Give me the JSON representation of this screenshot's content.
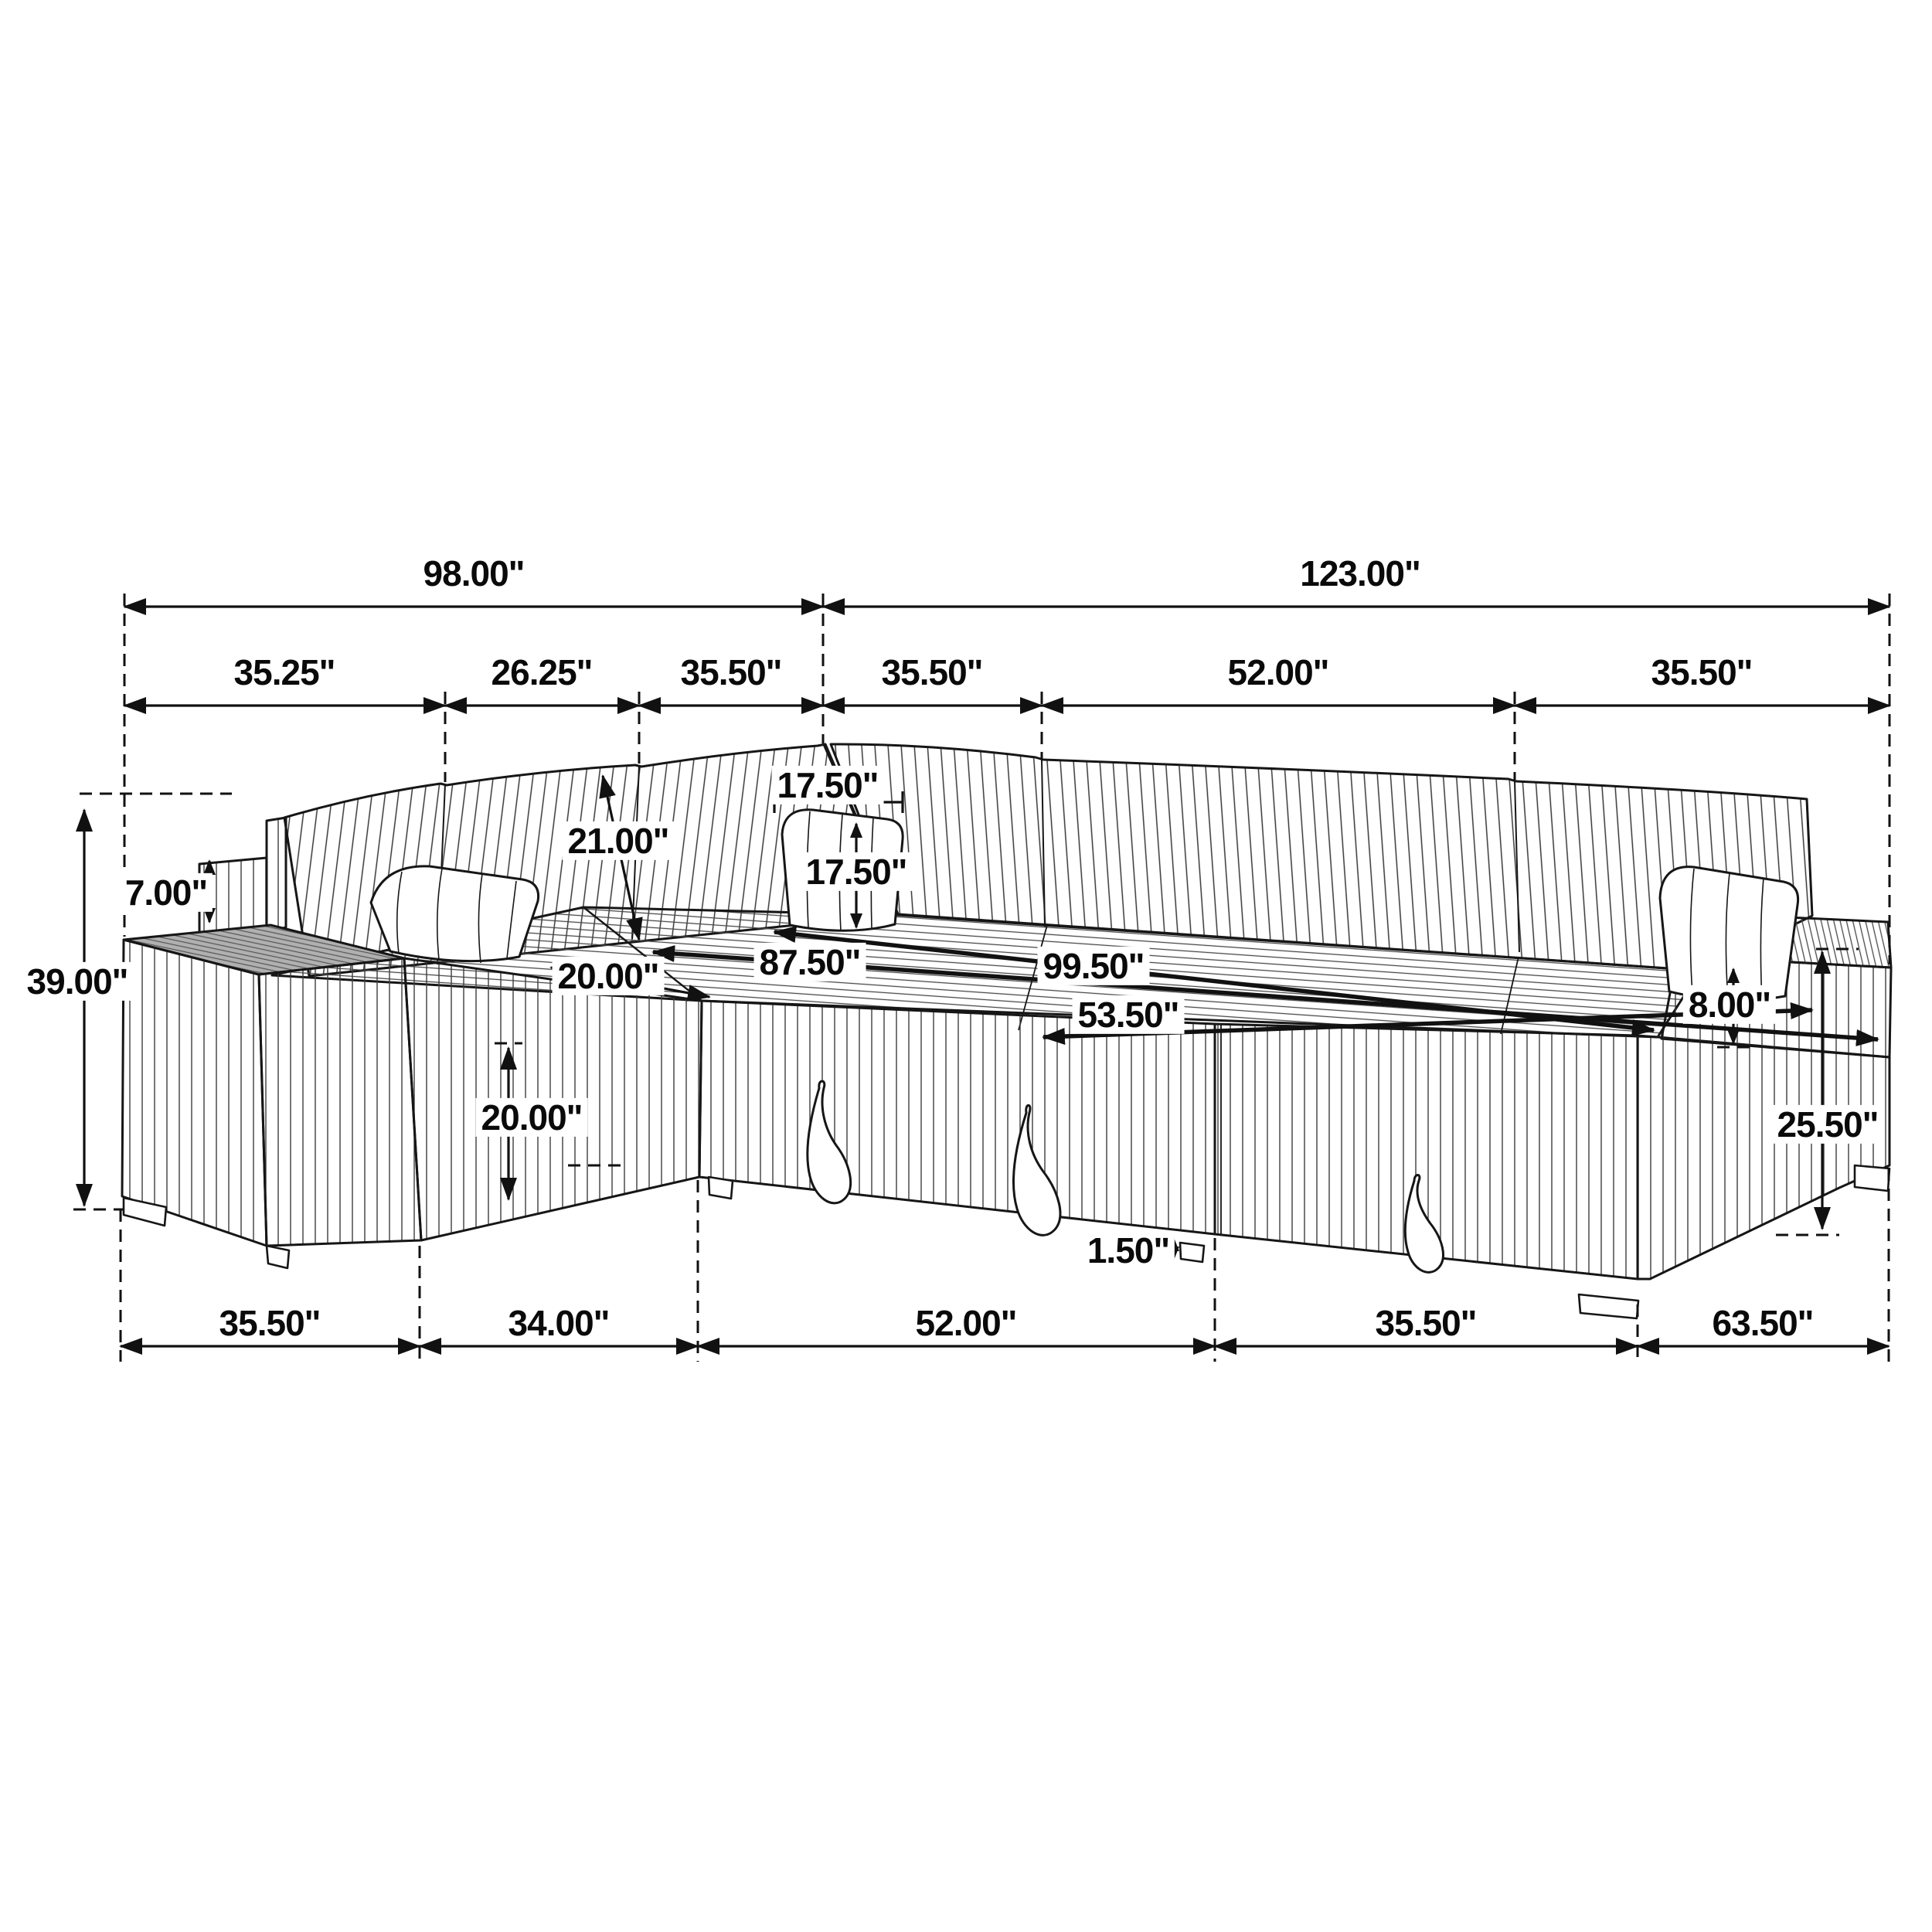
{
  "diagram": {
    "type": "furniture-dimension-diagram",
    "subject": "U-shaped sectional sleeper sofa with pull-out bed, storage chaise and armrest trays",
    "unit_suffix": "\"",
    "style": {
      "line_color": "#111111",
      "background": "#ffffff",
      "label_background": "#ffffff",
      "tray_gray": "#b0b0b0"
    }
  },
  "labels": {
    "dim_98": {
      "text": "98.00\""
    },
    "dim_123": {
      "text": "123.00\""
    },
    "dim_3525": {
      "text": "35.25\""
    },
    "dim_2625": {
      "text": "26.25\""
    },
    "dim_3550_a": {
      "text": "35.50\""
    },
    "dim_3550_b": {
      "text": "35.50\""
    },
    "dim_5200_a": {
      "text": "52.00\""
    },
    "dim_3550_c": {
      "text": "35.50\""
    },
    "dim_3900": {
      "text": "39.00\""
    },
    "dim_700": {
      "text": "7.00\""
    },
    "dim_2100": {
      "text": "21.00\""
    },
    "dim_1750_a": {
      "text": "17.50\""
    },
    "dim_1750_b": {
      "text": "17.50\""
    },
    "dim_2000_diag": {
      "text": "20.00\""
    },
    "dim_8750": {
      "text": "87.50\""
    },
    "dim_9950": {
      "text": "99.50\""
    },
    "dim_5350": {
      "text": "53.50\""
    },
    "dim_2000_vert": {
      "text": "20.00\""
    },
    "dim_800": {
      "text": "8.00\""
    },
    "dim_2550": {
      "text": "25.50\""
    },
    "dim_150": {
      "text": "1.50\""
    },
    "dim_3550_d": {
      "text": "35.50\""
    },
    "dim_3400": {
      "text": "34.00\""
    },
    "dim_5200_b": {
      "text": "52.00\""
    },
    "dim_3550_e": {
      "text": "35.50\""
    },
    "dim_6350": {
      "text": "63.50\""
    }
  },
  "dimensions": {
    "top_overall_segments": [
      "98.00\"",
      "123.00\""
    ],
    "top_sub_segments": [
      "35.25\"",
      "26.25\"",
      "35.50\"",
      "35.50\"",
      "52.00\"",
      "35.50\""
    ],
    "bottom_segments": [
      "35.50\"",
      "34.00\"",
      "52.00\"",
      "35.50\"",
      "63.50\""
    ],
    "overall_height": "39.00\"",
    "pillow_above_arm": "7.00\"",
    "back_cushion_height": "21.00\"",
    "throw_pillow_width": "17.50\"",
    "throw_pillow_height": "17.50\"",
    "seat_depth": "20.00\"",
    "seat_platform_lengths": [
      "87.50\"",
      "99.50\"",
      "53.50\""
    ],
    "front_face_height": "20.00\"",
    "arm_above_seat": "8.00\"",
    "arm_side_height": "25.50\"",
    "leg_height": "1.50\""
  }
}
